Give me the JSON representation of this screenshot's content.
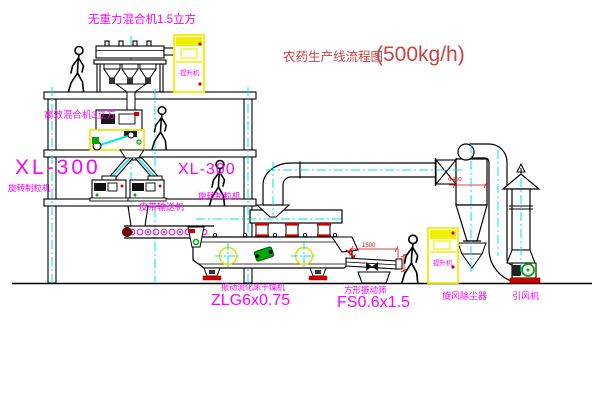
{
  "title": {
    "cn": "农药生产线流程图",
    "capacity": "(500kg/h)"
  },
  "labels": {
    "mixer_top": "无重力混合机1.5立方",
    "floor2_mixer": "高效混合机3立方",
    "xl_left_model": "XL-300",
    "xl_left_name": "旋转制粒机",
    "xl_right_model": "XL-300",
    "xl_right_name": "旋转制粒机",
    "belt_conveyor": "皮带输送机",
    "dryer_name": "振动流化床干燥机",
    "dryer_model": "ZLG6x0.75",
    "screen_name": "方形振动筛",
    "screen_model": "FS0.6x1.5",
    "cyclone": "旋风除尘器",
    "fan": "引风机",
    "hoist1": "提升机",
    "hoist2": "提升机"
  },
  "dimensions": {
    "screen_length": "1500",
    "cyclone_diameter": "Φ450"
  },
  "colors": {
    "label_magenta": "#ff00ff",
    "title_red": "#cf4040",
    "cad_red": "#dd0000",
    "centerline_cyan": "#00e5e5",
    "equipment_yellow": "#f0f000",
    "motor_green": "#00a800"
  }
}
